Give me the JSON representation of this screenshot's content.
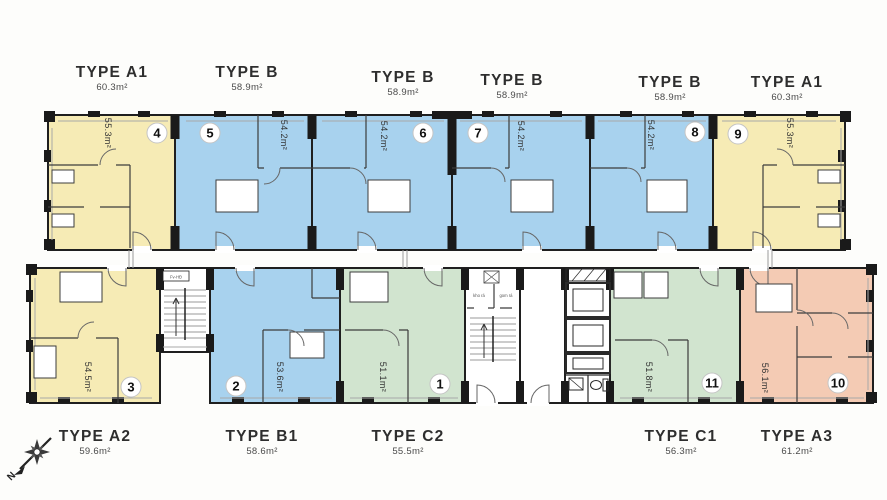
{
  "colors": {
    "type_a": "#F6EBB5",
    "type_b": "#A8D2EE",
    "type_c": "#D1E4CF",
    "type_a3": "#F4CBB4",
    "wall": "#1F1F1F",
    "core_fill": "#FFFFFF"
  },
  "top_row": [
    {
      "type": "TYPE A1",
      "type_area": "60.3m²",
      "unit": "4",
      "room_area": "55.3m²"
    },
    {
      "type": "TYPE B",
      "type_area": "58.9m²",
      "unit": "5",
      "room_area": "54.2m²"
    },
    {
      "type": "TYPE B",
      "type_area": "58.9m²",
      "unit": "6",
      "room_area": "54.2m²"
    },
    {
      "type": "TYPE B",
      "type_area": "58.9m²",
      "unit": "7",
      "room_area": "54.2m²"
    },
    {
      "type": "TYPE B",
      "type_area": "58.9m²",
      "unit": "8",
      "room_area": "54.2m²"
    },
    {
      "type": "TYPE A1",
      "type_area": "60.3m²",
      "unit": "9",
      "room_area": "55.3m²"
    }
  ],
  "bottom_row": [
    {
      "type": "TYPE A2",
      "type_area": "59.6m²",
      "unit": "3",
      "room_area": "54.5m²"
    },
    {
      "type": "TYPE B1",
      "type_area": "58.6m²",
      "unit": "2",
      "room_area": "53.6m²"
    },
    {
      "type": "TYPE C2",
      "type_area": "55.5m²",
      "unit": "1",
      "room_area": "51.1m²"
    },
    {
      "type": "TYPE C1",
      "type_area": "56.3m²",
      "unit": "11",
      "room_area": "51.8m²"
    },
    {
      "type": "TYPE A3",
      "type_area": "61.2m²",
      "unit": "10",
      "room_area": "56.1m²"
    }
  ],
  "core": {
    "stair_box_label": "Fv-HĐ",
    "trash_room_left": "kho rá",
    "trash_room_right": "gom rá"
  },
  "compass": {
    "north_label": "N"
  }
}
